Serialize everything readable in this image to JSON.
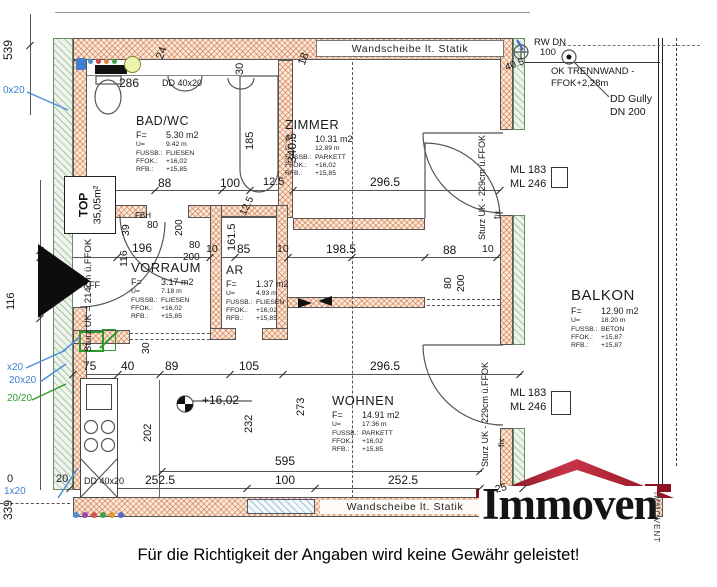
{
  "footer": {
    "disclaimer": "Für die Richtigkeit der Angaben wird keine Gewähr geleistet!"
  },
  "logo": {
    "text": "Immoven",
    "vertical_text": "IMMOVENT",
    "roof_color": "#8c1220"
  },
  "plan": {
    "wall_label_top": "Wandscheibe lt. Statik",
    "wall_label_bottom": "Wandscheibe lt. Statik",
    "unit_box": {
      "line1": "TOP",
      "line2": "35,05m²"
    },
    "colors": {
      "new_wall_hatch": "#cd6937",
      "existing_wall_hatch": "#6ea06e",
      "annotation_blue": "#3d7fd0",
      "annotation_green": "#2f9b2f",
      "roof_red": "#8c1220"
    },
    "rooms": [
      {
        "id": "badwc",
        "name": "BAD/WC",
        "x": 136,
        "y": 114,
        "ts": 12.5,
        "lines": [
          [
            "F=",
            "5.30 m2"
          ],
          [
            "U=",
            "9.42 m"
          ],
          [
            "FUSSB.:",
            "FLIESEN"
          ],
          [
            "FFOK.:",
            "+16,02"
          ],
          [
            "RFB.:",
            "+15,85"
          ]
        ]
      },
      {
        "id": "zimmer",
        "name": "ZIMMER",
        "x": 285,
        "y": 117,
        "ts": 13,
        "lines": [
          [
            "F=",
            "10.31 m2"
          ],
          [
            "U=",
            "12.89 m"
          ],
          [
            "FUSSB.:",
            "PARKETT"
          ],
          [
            "FFOK.:",
            "+16,02"
          ],
          [
            "RFB.:",
            "+15,85"
          ]
        ]
      },
      {
        "id": "vorraum",
        "name": "VORRAUM",
        "x": 131,
        "y": 260,
        "ts": 13,
        "lines": [
          [
            "F=",
            "3.17 m2"
          ],
          [
            "U=",
            "7.18 m"
          ],
          [
            "FUSSB.:",
            "FLIESEN"
          ],
          [
            "FFOK.:",
            "+16,02"
          ],
          [
            "RFB.:",
            "+15,85"
          ]
        ]
      },
      {
        "id": "ar",
        "name": "AR",
        "x": 226,
        "y": 263,
        "ts": 12,
        "lines": [
          [
            "F=",
            "1.37 m2"
          ],
          [
            "U=",
            "4.93 m"
          ],
          [
            "FUSSB.:",
            "FLIESEN"
          ],
          [
            "FFOK.:",
            "+16,02"
          ],
          [
            "RFB.:",
            "+15,85"
          ]
        ]
      },
      {
        "id": "wohnen",
        "name": "WOHNEN",
        "x": 332,
        "y": 393,
        "ts": 13,
        "lines": [
          [
            "F=",
            "14.91 m2"
          ],
          [
            "U=",
            "17.36 m"
          ],
          [
            "FUSSB.:",
            "PARKETT"
          ],
          [
            "FFOK.:",
            "+16,02"
          ],
          [
            "RFB.:",
            "+15,85"
          ]
        ]
      },
      {
        "id": "balkon",
        "name": "BALKON",
        "x": 571,
        "y": 287,
        "ts": 15,
        "lines": [
          [
            "F=",
            "12.90 m2"
          ],
          [
            "U=",
            "18.20 m"
          ],
          [
            "FUSSB.:",
            "BETON"
          ],
          [
            "FFOK.:",
            "+15,87"
          ],
          [
            "RFB.:",
            "+15,87"
          ]
        ]
      }
    ],
    "dim_labels": [
      {
        "t": "539",
        "x": 2,
        "y": 60,
        "r": -90,
        "s": 12
      },
      {
        "t": "0x20",
        "x": 3,
        "y": 86,
        "c": "b",
        "s": 10
      },
      {
        "t": "x20",
        "x": 7,
        "y": 363,
        "c": "b",
        "s": 10
      },
      {
        "t": "20x20",
        "x": 9,
        "y": 376,
        "c": "b",
        "s": 10
      },
      {
        "t": "20/20",
        "x": 7,
        "y": 394,
        "c": "g",
        "s": 10
      },
      {
        "t": "0",
        "x": 7,
        "y": 474,
        "s": 11
      },
      {
        "t": "20",
        "x": 56,
        "y": 474,
        "s": 11
      },
      {
        "t": "1x20",
        "x": 4,
        "y": 487,
        "c": "b",
        "s": 10
      },
      {
        "t": "339",
        "x": 2,
        "y": 520,
        "r": -90,
        "s": 12
      },
      {
        "t": "116",
        "x": 6,
        "y": 310,
        "r": -90,
        "s": 11
      },
      {
        "t": "Sturz UK = 214cm ü.FFOK",
        "x": 84,
        "y": 352,
        "r": -90,
        "s": 9.5
      },
      {
        "t": "OKFF",
        "x": 76,
        "y": 281,
        "s": 9
      },
      {
        "t": "7.5",
        "x": 64,
        "y": 213,
        "s": 11
      },
      {
        "t": "286",
        "x": 119,
        "y": 77,
        "s": 12
      },
      {
        "t": "DD 40x20",
        "x": 162,
        "y": 79,
        "s": 9
      },
      {
        "t": "24",
        "x": 155,
        "y": 57,
        "r": -70,
        "s": 11
      },
      {
        "t": "30",
        "x": 235,
        "y": 75,
        "r": -90,
        "s": 11
      },
      {
        "t": "18",
        "x": 297,
        "y": 63,
        "r": -70,
        "s": 11
      },
      {
        "t": "WM",
        "x": 85,
        "y": 196,
        "r": -90,
        "s": 9.5
      },
      {
        "t": "98",
        "x": 101,
        "y": 177,
        "s": 12
      },
      {
        "t": "88",
        "x": 158,
        "y": 177,
        "s": 12
      },
      {
        "t": "100",
        "x": 220,
        "y": 177,
        "s": 12
      },
      {
        "t": "12.5",
        "x": 263,
        "y": 177,
        "s": 11
      },
      {
        "t": "185",
        "x": 245,
        "y": 150,
        "r": -90,
        "s": 11
      },
      {
        "t": "340.5",
        "x": 286,
        "y": 163,
        "r": -90,
        "s": 12
      },
      {
        "t": "296.5",
        "x": 370,
        "y": 176,
        "s": 12
      },
      {
        "t": "FBH",
        "x": 135,
        "y": 212,
        "s": 8
      },
      {
        "t": "39",
        "x": 121,
        "y": 236,
        "r": -90,
        "s": 10.5
      },
      {
        "t": "80",
        "x": 147,
        "y": 221,
        "s": 10
      },
      {
        "t": "200",
        "x": 175,
        "y": 236,
        "r": -90,
        "s": 10
      },
      {
        "t": "116",
        "x": 119,
        "y": 267,
        "r": -90,
        "s": 10.5
      },
      {
        "t": "196",
        "x": 132,
        "y": 242,
        "s": 12
      },
      {
        "t": "80",
        "x": 189,
        "y": 241,
        "s": 10
      },
      {
        "t": "200",
        "x": 183,
        "y": 253,
        "s": 10
      },
      {
        "t": "10",
        "x": 206,
        "y": 244,
        "s": 10.5
      },
      {
        "t": "85",
        "x": 237,
        "y": 243,
        "s": 12
      },
      {
        "t": "10",
        "x": 277,
        "y": 244,
        "s": 10.5
      },
      {
        "t": "198.5",
        "x": 326,
        "y": 243,
        "s": 12
      },
      {
        "t": "88",
        "x": 443,
        "y": 244,
        "s": 12
      },
      {
        "t": "10",
        "x": 482,
        "y": 244,
        "s": 10.5
      },
      {
        "t": "161.5",
        "x": 227,
        "y": 251,
        "r": -90,
        "s": 11
      },
      {
        "t": "12.5",
        "x": 239,
        "y": 213,
        "r": -65,
        "s": 10
      },
      {
        "t": "80",
        "x": 443,
        "y": 289,
        "r": -90,
        "s": 10.5
      },
      {
        "t": "200",
        "x": 456,
        "y": 292,
        "r": -90,
        "s": 10.5
      },
      {
        "t": "40.5",
        "x": 504,
        "y": 64,
        "r": -20,
        "s": 10
      },
      {
        "t": "RW DN",
        "x": 534,
        "y": 38,
        "s": 9.5
      },
      {
        "t": "100",
        "x": 540,
        "y": 48,
        "s": 9.5
      },
      {
        "t": "OK TRENNWAND -",
        "x": 551,
        "y": 67,
        "s": 9.5
      },
      {
        "t": "FFOK+2,28m",
        "x": 551,
        "y": 79,
        "s": 9.5
      },
      {
        "t": "DD Gully",
        "x": 610,
        "y": 94,
        "s": 10.5
      },
      {
        "t": "DN 200",
        "x": 610,
        "y": 107,
        "s": 10.5
      },
      {
        "t": "ML 183",
        "x": 510,
        "y": 165,
        "s": 11
      },
      {
        "t": "ML 246",
        "x": 510,
        "y": 179,
        "s": 11
      },
      {
        "t": "Sturz UK - 229cm ü.FFOK",
        "x": 478,
        "y": 240,
        "r": -90,
        "s": 9
      },
      {
        "t": "fix",
        "x": 493,
        "y": 219,
        "r": -90,
        "s": 8.5
      },
      {
        "t": "ML 183",
        "x": 510,
        "y": 388,
        "s": 11
      },
      {
        "t": "ML 246",
        "x": 510,
        "y": 402,
        "s": 11
      },
      {
        "t": "Sturz UK - 229cm ü.FFOK",
        "x": 481,
        "y": 467,
        "r": -90,
        "s": 9
      },
      {
        "t": "fix",
        "x": 497,
        "y": 447,
        "r": -90,
        "s": 8.5
      },
      {
        "t": "30",
        "x": 141,
        "y": 354,
        "r": -90,
        "s": 10.5
      },
      {
        "t": "75",
        "x": 83,
        "y": 360,
        "s": 12
      },
      {
        "t": "40",
        "x": 121,
        "y": 360,
        "s": 12
      },
      {
        "t": "89",
        "x": 165,
        "y": 360,
        "s": 12
      },
      {
        "t": "105",
        "x": 239,
        "y": 360,
        "s": 12
      },
      {
        "t": "296.5",
        "x": 370,
        "y": 360,
        "s": 12
      },
      {
        "t": "+16,02",
        "x": 202,
        "y": 394,
        "s": 12
      },
      {
        "t": "202",
        "x": 143,
        "y": 442,
        "r": -90,
        "s": 11
      },
      {
        "t": "232",
        "x": 244,
        "y": 433,
        "r": -90,
        "s": 11
      },
      {
        "t": "273",
        "x": 296,
        "y": 416,
        "r": -90,
        "s": 11
      },
      {
        "t": "595",
        "x": 275,
        "y": 455,
        "s": 12
      },
      {
        "t": "252.5",
        "x": 145,
        "y": 474,
        "s": 12
      },
      {
        "t": "100",
        "x": 275,
        "y": 474,
        "s": 12
      },
      {
        "t": "252.5",
        "x": 388,
        "y": 474,
        "s": 12
      },
      {
        "t": "25",
        "x": 494,
        "y": 485,
        "r": -15,
        "s": 10.5
      },
      {
        "t": "DD 40x20",
        "x": 84,
        "y": 477,
        "s": 9
      }
    ],
    "ticks": [
      [
        95,
        190
      ],
      [
        155,
        190
      ],
      [
        222,
        190
      ],
      [
        250,
        190
      ],
      [
        293,
        190
      ],
      [
        500,
        190
      ],
      [
        40,
        257
      ],
      [
        117,
        257
      ],
      [
        210,
        257
      ],
      [
        235,
        257
      ],
      [
        288,
        257
      ],
      [
        352,
        257
      ],
      [
        425,
        257
      ],
      [
        497,
        257
      ],
      [
        73,
        374
      ],
      [
        118,
        374
      ],
      [
        160,
        374
      ],
      [
        230,
        374
      ],
      [
        283,
        374
      ],
      [
        520,
        374
      ],
      [
        162,
        471
      ],
      [
        480,
        471
      ],
      [
        70,
        488
      ],
      [
        247,
        488
      ],
      [
        315,
        488
      ],
      [
        480,
        488
      ],
      [
        523,
        488
      ],
      [
        40,
        250
      ],
      [
        40,
        318
      ],
      [
        30,
        45
      ]
    ],
    "dots": [
      {
        "x": 90,
        "y": 61,
        "d": 5,
        "c": "#4a90d9"
      },
      {
        "x": 98,
        "y": 61,
        "d": 5,
        "c": "#cc4444"
      },
      {
        "x": 106,
        "y": 61,
        "d": 5,
        "c": "#dd8833"
      },
      {
        "x": 114,
        "y": 61,
        "d": 5,
        "c": "#44a044"
      },
      {
        "x": 99,
        "y": 210,
        "d": 5,
        "c": "#cc3333"
      },
      {
        "x": 106,
        "y": 210,
        "d": 5,
        "c": "#3344cc"
      },
      {
        "x": 113,
        "y": 210,
        "d": 5,
        "c": "#222222"
      },
      {
        "x": 76,
        "y": 515,
        "d": 6,
        "c": "#4a90d9"
      },
      {
        "x": 85,
        "y": 515,
        "d": 6,
        "c": "#9944aa"
      },
      {
        "x": 94,
        "y": 515,
        "d": 6,
        "c": "#cc5555"
      },
      {
        "x": 103,
        "y": 515,
        "d": 6,
        "c": "#44a044"
      },
      {
        "x": 112,
        "y": 515,
        "d": 6,
        "c": "#dd9933"
      },
      {
        "x": 121,
        "y": 515,
        "d": 6,
        "c": "#5566cc"
      }
    ]
  }
}
